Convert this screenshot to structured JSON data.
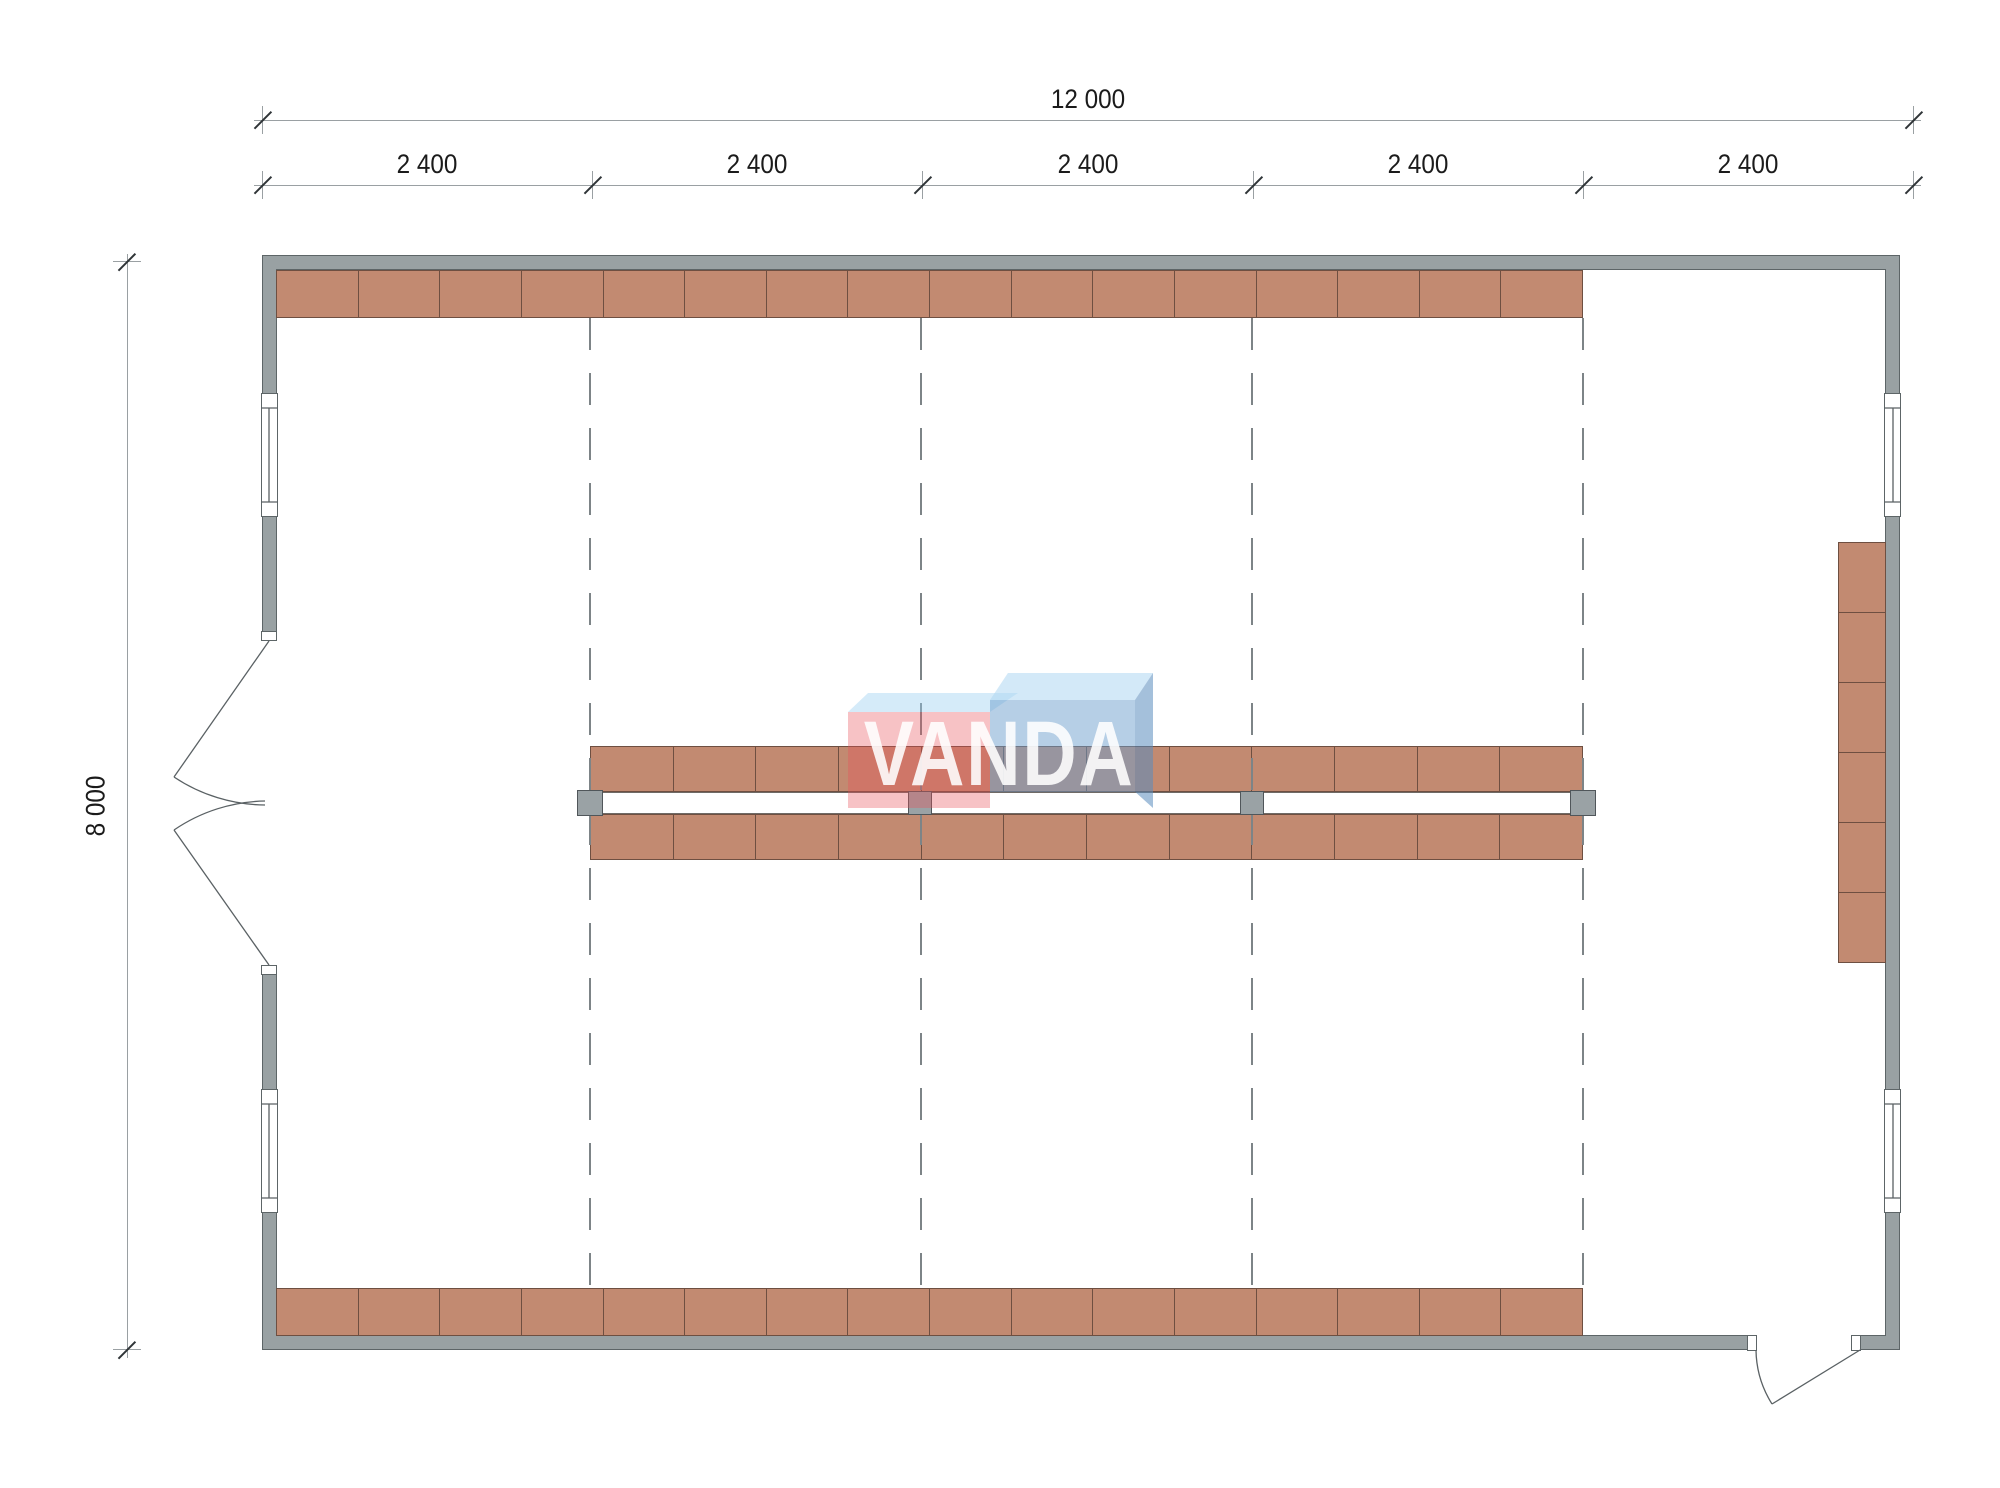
{
  "drawing": {
    "type": "floor-plan",
    "dimensions": {
      "total_width_label": "12 000",
      "bay_labels": [
        "2 400",
        "2 400",
        "2 400",
        "2 400",
        "2 400"
      ],
      "height_label": "8 000"
    },
    "logo": {
      "text": "VANDA"
    },
    "shelving": {
      "top_row_units": 16,
      "bottom_row_units": 16,
      "island_top_units": 12,
      "island_bottom_units": 12,
      "right_column_units": 6
    }
  },
  "colors": {
    "wall_fill": "#99a1a3",
    "wall_border": "#5d6567",
    "shelf_fill": "#c28a71",
    "shelf_border": "#6e4f41",
    "channel_border": "#6f6a66",
    "column_fill": "#9aa2a5",
    "column_border": "#50565a",
    "grid_line": "#7d8487",
    "dim_line": "#9aa0a3",
    "tick": "#2f3437",
    "dim_text": "#1b1b1b",
    "door_line": "#5a6164",
    "logo_red_front": "rgba(233,80,90,0.35)",
    "logo_red_top": "rgba(150,205,240,0.4)",
    "logo_blue_front": "rgba(110,160,205,0.5)",
    "logo_blue_top": "rgba(175,215,242,0.55)",
    "logo_blue_side": "rgba(90,140,190,0.55)",
    "logo_text": "rgba(255,255,255,0.88)"
  }
}
